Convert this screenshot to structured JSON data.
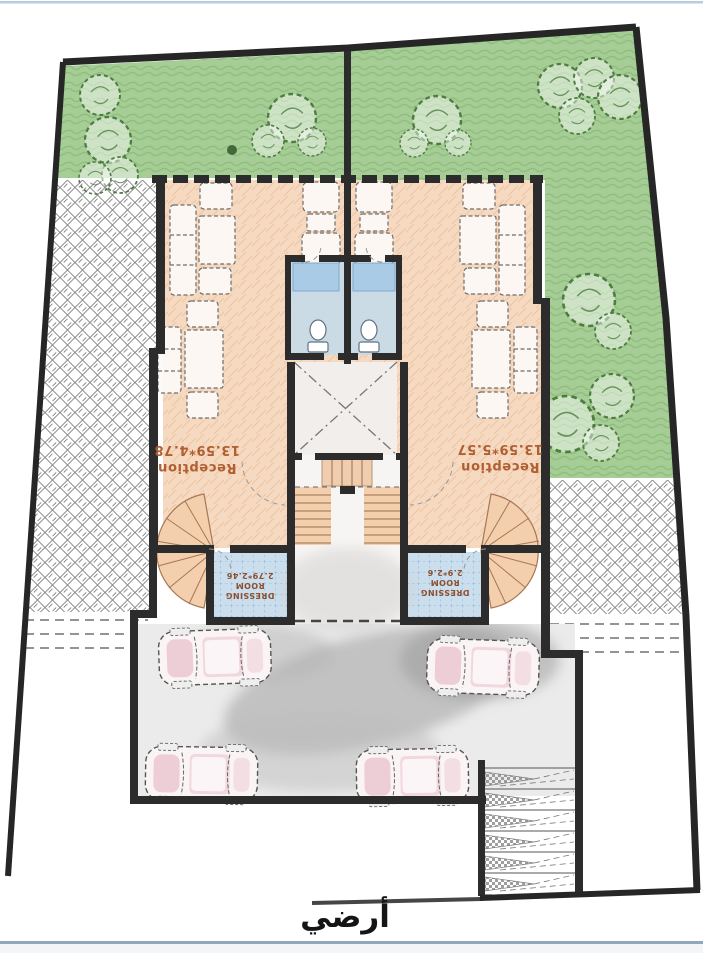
{
  "document": {
    "floor_title": "أرضي"
  },
  "rooms": {
    "reception_left": {
      "name": "Reception",
      "dims": "13.59*4.78"
    },
    "reception_right": {
      "name": "Reception",
      "dims": "13.59*5.57"
    },
    "dressing_left": {
      "name_line1": "DRESSING",
      "name_line2": "ROOM",
      "dims": "2.79*2.46"
    },
    "dressing_right": {
      "name_line1": "DRESSING",
      "name_line2": "ROOM",
      "dims": "2.9*2.6"
    }
  },
  "colors": {
    "wall_ink": "#2c2c2c",
    "garden_green": "#a6cd96",
    "reception_floor": "#f5d9c0",
    "wet_area": "#c3daec",
    "stair_tan": "#f3cfad",
    "garage_gray": "#ebebeb",
    "car_pink": "#e3aebe",
    "room_label_ink": "#b05f33",
    "dressing_label_ink": "#8d4f2c",
    "title_ink": "#151515",
    "scan_line_top": "#b7cee0",
    "scan_line_bottom": "#93a7ba"
  }
}
